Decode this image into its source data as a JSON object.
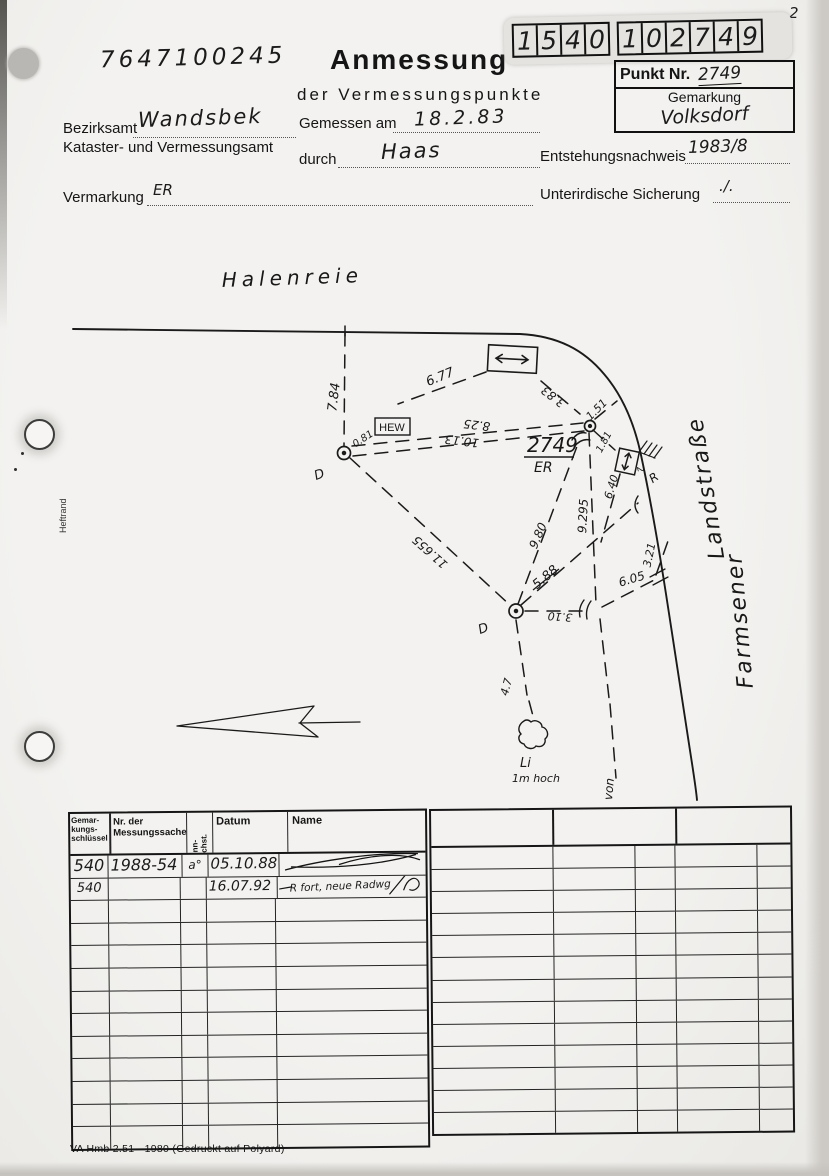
{
  "page": {
    "number": "2",
    "doc_number": "7647100245",
    "heftrand": "Heftrand",
    "footer": "VA Hmb 2.51 - 1980 (Gedruckt auf Polyard)"
  },
  "header": {
    "title": "Anmessung",
    "subtitle": "der Vermessungspunkte",
    "digits1": [
      "1",
      "5",
      "4",
      "0"
    ],
    "digits2": [
      "1",
      "0",
      "2",
      "7",
      "4",
      "9"
    ],
    "punkt_nr_label": "Punkt Nr.",
    "punkt_nr_value": "2749",
    "gemarkung_label": "Gemarkung",
    "gemarkung_value": "Volksdorf"
  },
  "form": {
    "bezirksamt_label": "Bezirksamt",
    "bezirksamt_value": "Wandsbek",
    "kataster_label": "Kataster- und Vermessungsamt",
    "gemessen_label": "Gemessen am",
    "gemessen_value": "18.2.83",
    "durch_label": "durch",
    "durch_value": "Haas",
    "entstehung_label": "Entstehungsnachweis",
    "entstehung_value": "1983/8",
    "vermarkung_label": "Vermarkung",
    "vermarkung_value": "ER",
    "sicherung_label": "Unterirdische Sicherung",
    "sicherung_value": "./."
  },
  "sketch": {
    "street_top": "Halenreie",
    "street_right_word1": "Farmsener",
    "street_right_word2": "Landstraße",
    "point_number": "2749",
    "point_marking": "ER",
    "hew": "HEW",
    "d_left": "D",
    "d_bottom": "D",
    "r_mark": "R",
    "valve_digit": "2",
    "li": "Li",
    "li_height": "1m hoch",
    "von": "von",
    "measurements": {
      "m7_84": "7.84",
      "m6_77": "6.77",
      "m0_81": "0.81",
      "m8_25": "8.25",
      "m10_13": "10.13",
      "m3_83": "3.83",
      "m1_51": "1.51",
      "m1_81": "1.81",
      "m6_40": "6.40",
      "m9_295": "9.295",
      "m9_80": "9.80",
      "m5_88": "5.88",
      "m11_655": "11.655",
      "m3_10": "3.10",
      "m6_05": "6.05",
      "m3_21": "3.21",
      "m4_7": "4.7"
    }
  },
  "table": {
    "headers": {
      "col1": "Gemar-\nkungs-\nschlüssel",
      "col2": "Nr. der\nMessungssache",
      "col3": "Kenn-\nbuchst.",
      "col4": "Datum",
      "col5": "Name"
    },
    "rows": [
      {
        "schluessel": "540",
        "messungssache": "1988-54",
        "kenn": "a°",
        "datum": "05.10.88",
        "name": ""
      },
      {
        "schluessel": "540",
        "messungssache": "",
        "kenn": "",
        "datum": "16.07.92",
        "name": "R fort, neue Radwg"
      }
    ]
  }
}
